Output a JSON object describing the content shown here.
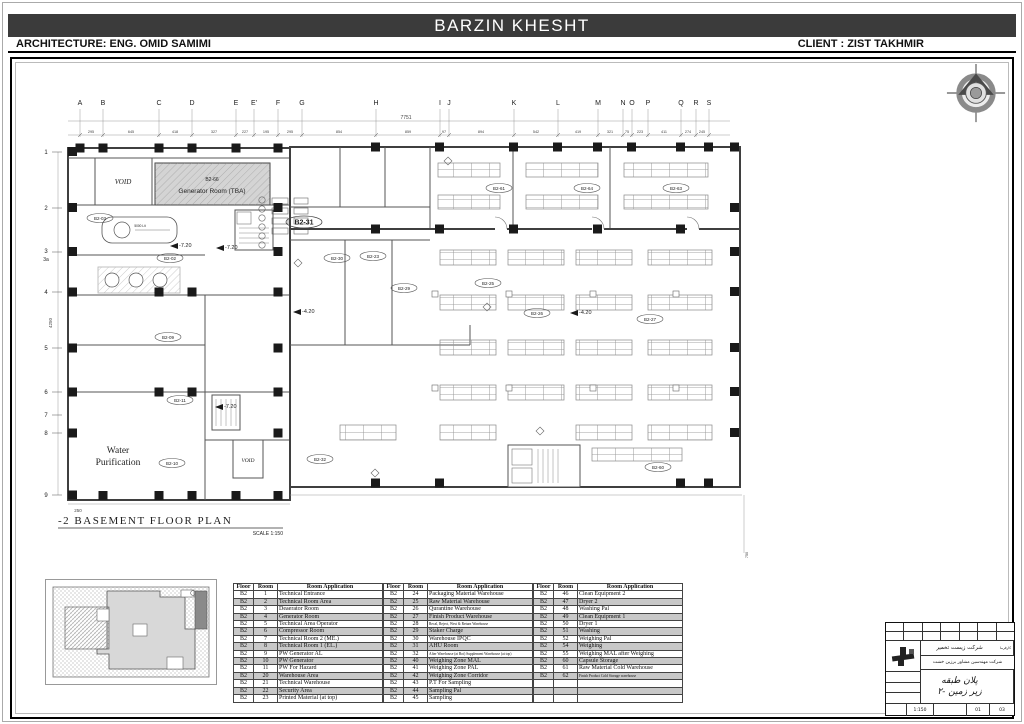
{
  "header": {
    "title": "BARZIN KHESHT",
    "architecture": "ARCHITECTURE: ENG.  OMID SAMIMI",
    "client": "CLIENT : ZIST TAKHMIR"
  },
  "plan": {
    "title": "-2 BASEMENT FLOOR PLAN",
    "scale": "SCALE  1:150",
    "overall_dim": "7751",
    "left_dim": "4250",
    "dim_250": "250",
    "dim_right": "750",
    "grid_cols": [
      "A",
      "B",
      "C",
      "D",
      "E",
      "E'",
      "F",
      "G",
      "H",
      "I",
      "J",
      "K",
      "L",
      "M",
      "N",
      "O",
      "P",
      "Q",
      "R",
      "S"
    ],
    "grid_rows": [
      "1",
      "2",
      "3",
      "3a",
      "4",
      "5",
      "6",
      "7",
      "8",
      "9"
    ],
    "dims_top": [
      "295",
      "645",
      "418",
      "327",
      "227",
      "195",
      "295",
      "854",
      "859",
      "97",
      "894",
      "542",
      "419",
      "321",
      "75",
      "223",
      "411",
      "274",
      "245"
    ],
    "labels": {
      "void_top": "VOID",
      "void_bottom": "VOID",
      "generator_tag": "B2-66",
      "generator_name": "Generator Room (TBA)",
      "water_line1": "Water",
      "water_line2": "Purification",
      "main_tag": "B2-31",
      "tank": "5000 Lit"
    },
    "tags": [
      "B2-03",
      "B2-02",
      "B2-09",
      "B2-11",
      "B2-10",
      "B2-30",
      "B2-23",
      "B2-29",
      "B2-32",
      "B2-25",
      "B2-26",
      "B2-27",
      "B2-61",
      "B2-64",
      "B2-63",
      "B2-60"
    ],
    "elevations": [
      "-7.20",
      "-7.20",
      "-4.20",
      "-4.20",
      "-7.20"
    ]
  },
  "table": {
    "headers": [
      "Floor",
      "Room",
      "Room Application"
    ],
    "groups": [
      {
        "rows": [
          [
            "B2",
            "1",
            "Technical Entrance"
          ],
          [
            "B2",
            "2",
            "Technical Room Area"
          ],
          [
            "B2",
            "3",
            "Deaerator Room"
          ],
          [
            "B2",
            "4",
            "Generator Room"
          ],
          [
            "B2",
            "5",
            "Technical Area Operator"
          ],
          [
            "B2",
            "6",
            "Compressor Room"
          ],
          [
            "B2",
            "7",
            "Technical Room 2 (ME.)"
          ],
          [
            "B2",
            "8",
            "Technical Room 1 (EL.)"
          ],
          [
            "B2",
            "9",
            "PW Generator AL"
          ],
          [
            "B2",
            "10",
            "PW Generator"
          ],
          [
            "B2",
            "11",
            "PW For Hazard"
          ],
          [
            "B2",
            "20",
            "Warehouse Area"
          ],
          [
            "B2",
            "21",
            "Technical Warehouse"
          ],
          [
            "B2",
            "22",
            "Security Area"
          ],
          [
            "B2",
            "23",
            "Printed Material (at top)"
          ]
        ]
      },
      {
        "rows": [
          [
            "B2",
            "24",
            "Packaging Material Warehouse"
          ],
          [
            "B2",
            "25",
            "Raw Material Warehouse"
          ],
          [
            "B2",
            "26",
            "Qurantine Warehouse"
          ],
          [
            "B2",
            "27",
            "Finish Product Warehouse"
          ],
          [
            "B2",
            "28",
            "Recal, Reject, West & Return Warehouse"
          ],
          [
            "B2",
            "29",
            "Staker Charge"
          ],
          [
            "B2",
            "30",
            "Warehouse IPQC"
          ],
          [
            "B2",
            "31",
            "AHU Room"
          ],
          [
            "B2",
            "32",
            "After Warehouse (at Bot) Supplement Warehouse (at top)"
          ],
          [
            "B2",
            "40",
            "Weighing Zone MAL"
          ],
          [
            "B2",
            "41",
            "Weighing Zone PAL"
          ],
          [
            "B2",
            "42",
            "Weighing Zone Corridor"
          ],
          [
            "B2",
            "43",
            "P.T For Sampling"
          ],
          [
            "B2",
            "44",
            "Sampling Pal"
          ],
          [
            "B2",
            "45",
            "Sampling"
          ]
        ]
      },
      {
        "rows": [
          [
            "B2",
            "46",
            "Clean Equipment 2"
          ],
          [
            "B2",
            "47",
            "Dryer 2"
          ],
          [
            "B2",
            "48",
            "Washing Pal"
          ],
          [
            "B2",
            "49",
            "Clean Equipment 1"
          ],
          [
            "B2",
            "50",
            "Dryer 1"
          ],
          [
            "B2",
            "51",
            "Washing"
          ],
          [
            "B2",
            "52",
            "Weighing Pal"
          ],
          [
            "B2",
            "54",
            "Weighing"
          ],
          [
            "B2",
            "55",
            "Weighing MAL after Weighing"
          ],
          [
            "B2",
            "60",
            "Capsule Storage"
          ],
          [
            "B2",
            "61",
            "Raw Material Cold Warehouse"
          ],
          [
            "B2",
            "62",
            "Finish Product Cold Storage warehouse"
          ],
          [
            "",
            "",
            ""
          ],
          [
            "",
            "",
            ""
          ],
          [
            "",
            "",
            ""
          ]
        ]
      }
    ]
  },
  "titleblock": {
    "client_label": "کارفرما",
    "owner": "شرکت زیست تخمیر",
    "consultant": "شرکت مهندسین مشاور برزین خشت",
    "title_line1": "پلان طبقه",
    "title_line2": "زیر زمین -۲",
    "scale_value": "1:150",
    "rev": "01",
    "sheet": "03"
  }
}
